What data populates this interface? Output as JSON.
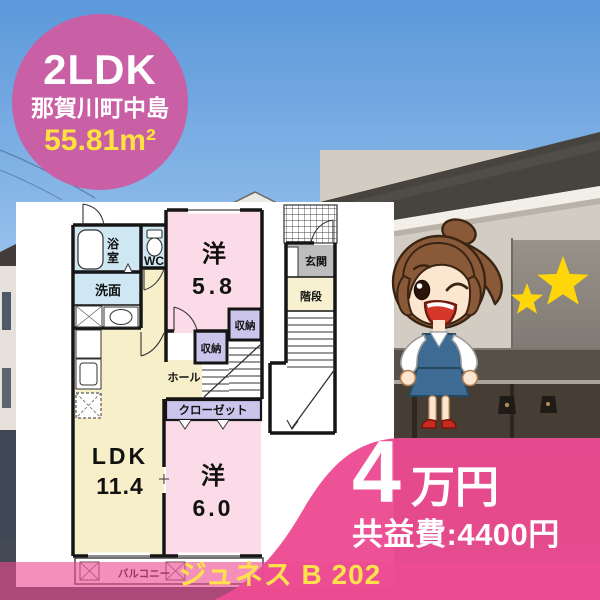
{
  "badge": {
    "layout": "2LDK",
    "location": "那賀川町中島",
    "area": "55.81m²"
  },
  "floor_plan": {
    "bath_line1": "浴",
    "bath_line2": "室",
    "wc": "WC",
    "washroom": "洗面",
    "room1_label": "洋",
    "room1_size": "5.8",
    "storage_a": "収納",
    "storage_b": "収納",
    "hall": "ホール",
    "closet": "クローゼット",
    "ldk_label": "LDK",
    "ldk_size": "11.4",
    "room2_label": "洋",
    "room2_size": "6.0",
    "balcony": "バルコニー",
    "entrance": "玄関",
    "stairs": "階段"
  },
  "price": {
    "amount": "4",
    "unit": "万円",
    "fee": "共益費:4400円"
  },
  "footer": {
    "property_name": "ジュネス B 202"
  },
  "colors": {
    "badge_pink": "#c95fa4",
    "accent_pink": "#ec4b92",
    "highlight_yellow": "#ffd60a",
    "text_yellow": "#ffe14d"
  }
}
